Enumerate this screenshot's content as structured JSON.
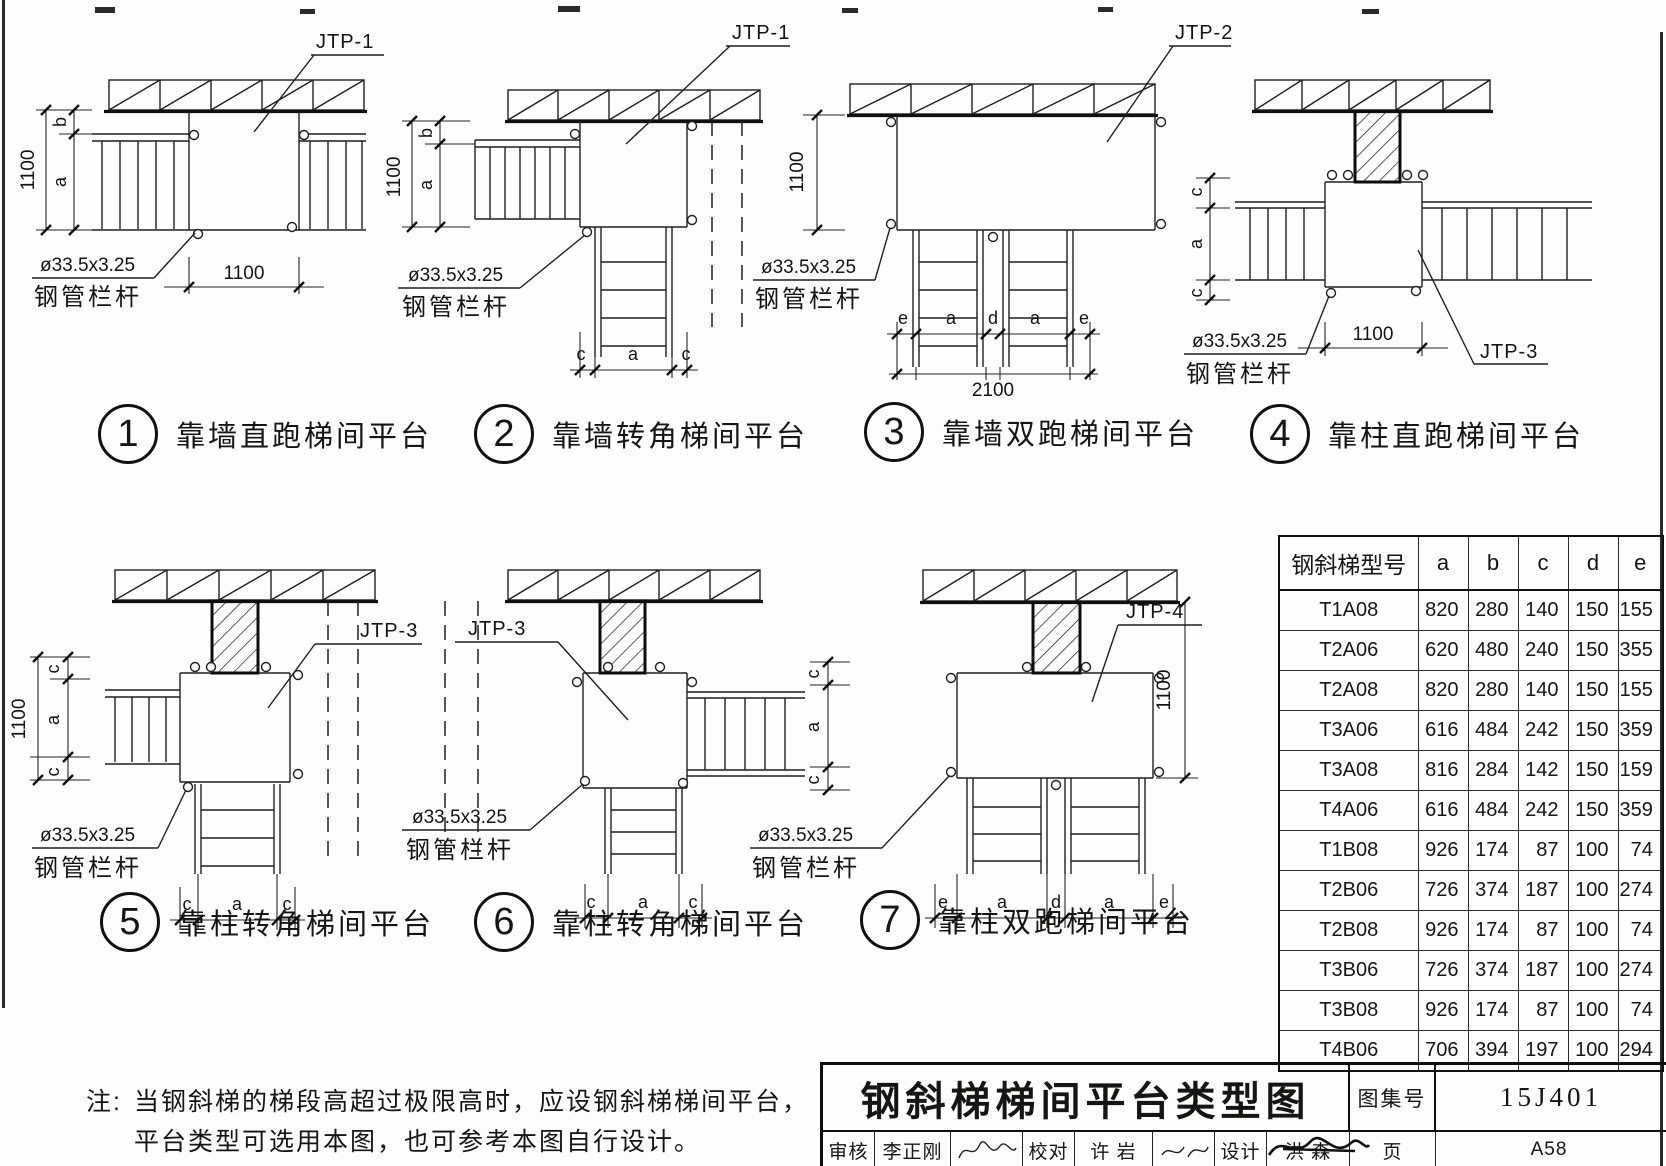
{
  "note": {
    "label": "注:",
    "line1": "当钢斜梯的梯段高超过极限高时，应设钢斜梯梯间平台，",
    "line2": "平台类型可选用本图，也可参考本图自行设计。"
  },
  "labels": {
    "jtp1": "JTP-1",
    "jtp2": "JTP-2",
    "jtp3": "JTP-3",
    "jtp4": "JTP-4",
    "pipe_spec": "ø33.5x3.25",
    "pipe_name": "钢管栏杆",
    "d1100": "1100",
    "d2100": "2100",
    "a": "a",
    "b": "b",
    "c": "c",
    "d": "d",
    "e": "e"
  },
  "figures": [
    {
      "num": "1",
      "caption": "靠墙直跑梯间平台"
    },
    {
      "num": "2",
      "caption": "靠墙转角梯间平台"
    },
    {
      "num": "3",
      "caption": "靠墙双跑梯间平台"
    },
    {
      "num": "4",
      "caption": "靠柱直跑梯间平台"
    },
    {
      "num": "5",
      "caption": "靠柱转角梯间平台"
    },
    {
      "num": "6",
      "caption": "靠柱转角梯间平台"
    },
    {
      "num": "7",
      "caption": "靠柱双跑梯间平台"
    }
  ],
  "table": {
    "headers": [
      "钢斜梯型号",
      "a",
      "b",
      "c",
      "d",
      "e"
    ],
    "rows": [
      [
        "T1A08",
        "820",
        "280",
        "140",
        "150",
        "155"
      ],
      [
        "T2A06",
        "620",
        "480",
        "240",
        "150",
        "355"
      ],
      [
        "T2A08",
        "820",
        "280",
        "140",
        "150",
        "155"
      ],
      [
        "T3A06",
        "616",
        "484",
        "242",
        "150",
        "359"
      ],
      [
        "T3A08",
        "816",
        "284",
        "142",
        "150",
        "159"
      ],
      [
        "T4A06",
        "616",
        "484",
        "242",
        "150",
        "359"
      ],
      [
        "T1B08",
        "926",
        "174",
        "87",
        "100",
        "74"
      ],
      [
        "T2B06",
        "726",
        "374",
        "187",
        "100",
        "274"
      ],
      [
        "T2B08",
        "926",
        "174",
        "87",
        "100",
        "74"
      ],
      [
        "T3B06",
        "726",
        "374",
        "187",
        "100",
        "274"
      ],
      [
        "T3B08",
        "926",
        "174",
        "87",
        "100",
        "74"
      ],
      [
        "T4B06",
        "706",
        "394",
        "197",
        "100",
        "294"
      ]
    ]
  },
  "titleblock": {
    "title": "钢斜梯梯间平台类型图",
    "atlas_label": "图集号",
    "atlas_no": "15J401",
    "page_label": "页",
    "page_no": "A58",
    "review_label": "审核",
    "reviewer": "李正刚",
    "proof_label": "校对",
    "proofreader": "许  岩",
    "design_label": "设计",
    "designer": "洪  森"
  }
}
